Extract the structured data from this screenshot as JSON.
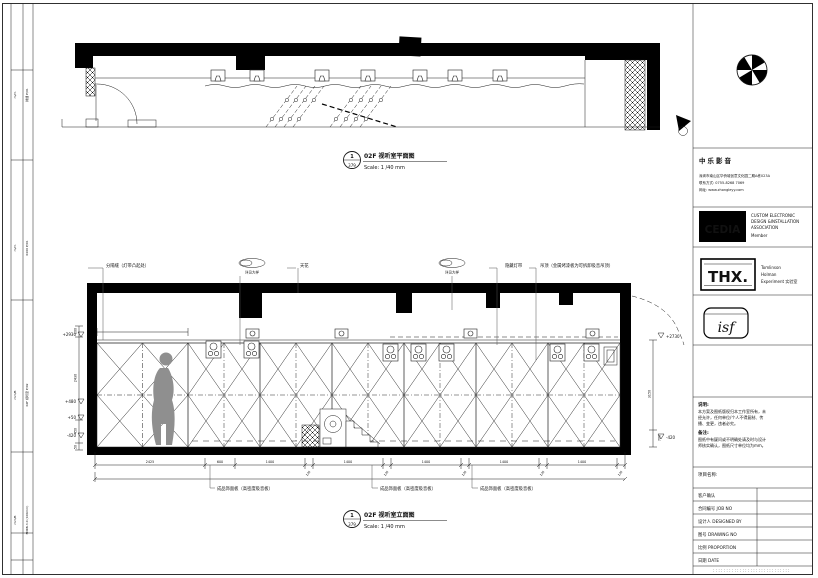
{
  "plan": {
    "bubble_no": "1",
    "bubble_sheet": "379",
    "title": "02F 视听室平面图",
    "scale": "Scale: 1 /40 mm"
  },
  "elevation": {
    "bubble_no": "1",
    "bubble_sheet": "379",
    "title": "02F 视听室立面图",
    "scale": "Scale: 1 /40 mm",
    "callouts": {
      "c1": "分隔缝（灯带凸起处）",
      "c2": "详见大样",
      "c3": "天花",
      "c4": "详见大样",
      "c5": "隐藏灯带",
      "c6": "吊顶（金属烤漆板为可拆卸吸音吊顶）",
      "finish_panel": "成品饰面板（高密度吸音板）"
    },
    "dims": {
      "bottom": [
        "2425",
        "600",
        "1400",
        "120",
        "1400",
        "120",
        "1400",
        "120",
        "1400",
        "120",
        "1400",
        "120"
      ],
      "left_levels": [
        "+2930",
        "+480",
        "+50",
        "-420"
      ],
      "left_chain": [
        "100",
        "2430",
        "450",
        "50"
      ],
      "right_levels": [
        "+2730",
        "-420"
      ],
      "right_chain": [
        "3150",
        "700"
      ]
    }
  },
  "titleblock": {
    "company": {
      "name": "中乐影音",
      "address": "深圳市南山区华侨城创意文化园二期A栋023A",
      "phone": "联系方式: 0755-8268 7069",
      "website": "网址: www.zhongleyy.com"
    },
    "cedia": {
      "logo": "CEDIA",
      "lines": [
        "CUSTOM ELECTRONIC",
        "DESIGN &INSTALLATION",
        "ASSOCIATION",
        "Member"
      ]
    },
    "thx": {
      "logo": "THX.",
      "lines": [
        "Tomlinson",
        "Holman",
        "Experiment 实验室"
      ]
    },
    "isf": {
      "logo": "isf"
    },
    "notes": {
      "title": "说明:",
      "lines": [
        "本方案及图纸版权归本工作室所有，未",
        "经允许，任何单位/个人不得复制、传",
        "播、变更，违者必究。"
      ],
      "remark_title": "备注:",
      "remark_lines": [
        "图纸中有疑问或不明确处请及时与设计",
        "师核实确认，图纸尺寸单位均为mm。"
      ]
    },
    "project_label": "项目名称:",
    "table": {
      "rows": [
        {
          "label": "客户确认"
        },
        {
          "label": "合同编号  JOB NO"
        },
        {
          "label": "设计人  DESIGNED BY"
        },
        {
          "label": "图号  DRAWING NO"
        },
        {
          "label": "比例  PROPORTION"
        },
        {
          "label": "日期  DATE"
        }
      ]
    },
    "footer_marks": ":::::::::::::::::::::::::::::"
  },
  "left_margin": {
    "labels": [
      {
        "col1": "m/m",
        "col2": "排烟 P/01",
        "y": 95
      },
      {
        "col1": "m/m",
        "col2": "0400 P/01",
        "y": 248
      },
      {
        "col1": "mm/B",
        "col2": "02F 视听室 P/02",
        "y": 395
      },
      {
        "col1": "mm/B",
        "col2": "FDKB-3.0 (100mm)",
        "y": 520
      }
    ]
  }
}
